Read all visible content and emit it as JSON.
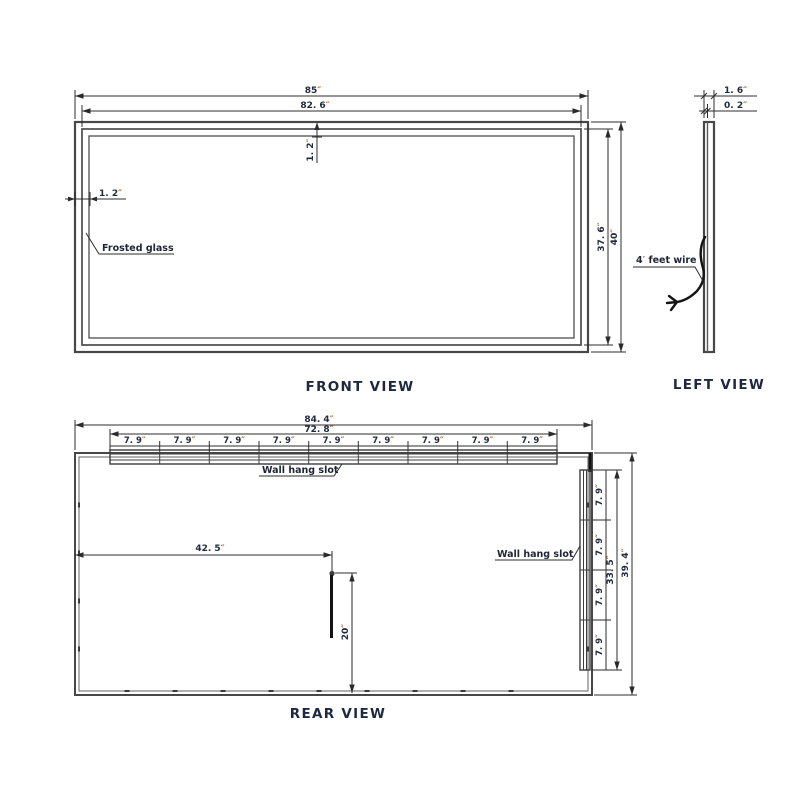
{
  "drawing": {
    "views": {
      "front": {
        "title": "FRONT VIEW"
      },
      "left": {
        "title": "LEFT VIEW"
      },
      "rear": {
        "title": "REAR VIEW"
      }
    },
    "front": {
      "width_outer": {
        "v": "85",
        "u": "″"
      },
      "width_inner": {
        "v": "82. 6",
        "u": "″"
      },
      "frame_top": {
        "v": "1. 2",
        "u": "″"
      },
      "frame_side": {
        "v": "1. 2",
        "u": "″"
      },
      "height_inner": {
        "v": "37. 6",
        "u": "″"
      },
      "height_outer": {
        "v": "40",
        "u": "″"
      },
      "frosted_glass_label": "Frosted glass"
    },
    "left": {
      "thickness": {
        "v": "1. 6",
        "u": "″"
      },
      "panel": {
        "v": "0. 2",
        "u": "″"
      },
      "wire_label": {
        "v": "4",
        "u": "′",
        "rest": " feet wire"
      }
    },
    "rear": {
      "width_outer": {
        "v": "84. 4",
        "u": "″"
      },
      "slot_width": {
        "v": "72. 8",
        "u": "″"
      },
      "slot_segment": {
        "v": "7. 9",
        "u": "″"
      },
      "cord_offset": {
        "v": "42. 5",
        "u": "″"
      },
      "cord_drop": {
        "v": "20",
        "u": "″"
      },
      "slot_height": {
        "v": "33. 5",
        "u": "″"
      },
      "height_outer": {
        "v": "39. 4",
        "u": "″"
      },
      "wall_hang_slot_top": "Wall hang slot",
      "wall_hang_slot_right": "Wall hang slot"
    },
    "colors": {
      "ink": "#232c3e",
      "unit_mark": "#b35c20",
      "line": "#2e2e2e",
      "title": "#1e2940"
    }
  }
}
